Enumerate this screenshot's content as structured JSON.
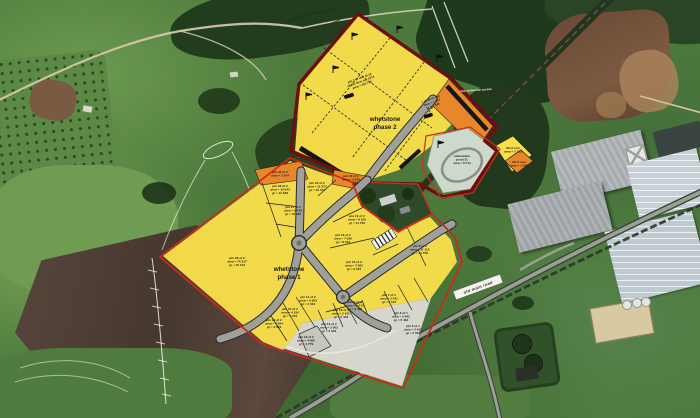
{
  "overlay": {
    "phase2_title_line1": "whetstone",
    "phase2_title_line2": "phase 2",
    "phase1_title_line1": "whetstone",
    "phase1_title_line2": "phase 1",
    "road_label": "old main road",
    "pedestrian_note": "new pedestrian access",
    "pond_note": {
      "l1": "attenuation",
      "l2": "pond 31",
      "l3": "area = 8 714"
    },
    "p2_note1": {
      "l1": "ptn 1 of rem of 12",
      "l2": "of the farm no. 1573",
      "l3": "area = 403 712"
    },
    "p2_note2": {
      "l1": "1 of 29 of rem",
      "l2": "area = 1 727",
      "l3": "gr = 1 694"
    }
  },
  "parcels": [
    {
      "id": "ptn 28 of 2",
      "area": "area = 74 217",
      "gr": "gr = 16 142",
      "x": 237,
      "y": 259
    },
    {
      "id": "ptn 26 of 2",
      "area": "area = 13 043",
      "gr": "gr = 12 569",
      "x": 280,
      "y": 187
    },
    {
      "id": "ptn 25 of 2",
      "area": "area = 11 374",
      "gr": "gr = 10 372",
      "x": 317,
      "y": 184
    },
    {
      "id": "ptn 27 of 2",
      "area": "area = 9 479",
      "gr": "gr = 10 005",
      "x": 293,
      "y": 208
    },
    {
      "id": "ptn 19 of 2",
      "area": "area = 9 155",
      "gr": "gr = 11 479",
      "x": 357,
      "y": 217
    },
    {
      "id": "ptn 18 of 2",
      "area": "area = 7 536",
      "gr": "gr = 8 941",
      "x": 343,
      "y": 236
    },
    {
      "id": "ptn 16 of 2",
      "area": "area = 7 582",
      "gr": "gr = 9 091",
      "x": 354,
      "y": 263
    },
    {
      "id": "ptn 8 of 1",
      "area": "area = 11 115",
      "gr": "gr = 11 758",
      "x": 420,
      "y": 247
    },
    {
      "id": "ptn 11 of 2",
      "area": "area = 5 923",
      "gr": "gr = 4 313",
      "x": 308,
      "y": 298
    },
    {
      "id": "ptn 15 of 2",
      "area": "area = 4 155",
      "gr": "gr = 4 254",
      "x": 290,
      "y": 310
    },
    {
      "id": "ptn 14 of 2",
      "area": "area = 4 594",
      "gr": "gr = 4 523",
      "x": 274,
      "y": 321
    },
    {
      "id": "ptn 13 of 2",
      "area": "area = 4 565",
      "gr": "gr = 4 779",
      "x": 306,
      "y": 338
    },
    {
      "id": "ptn 12 of 2",
      "area": "area = 3 502",
      "gr": "gr = 3 944",
      "x": 329,
      "y": 325
    },
    {
      "id": "ptn 10 of 2",
      "area": "area = 2 411",
      "gr": "gr = 2 432",
      "x": 341,
      "y": 311
    },
    {
      "id": "ptn 9 of 2",
      "area": "area = 3 413",
      "gr": "gr = 3 437",
      "x": 355,
      "y": 303
    },
    {
      "id": "ptn 7 of 1",
      "area": "area = 2 341",
      "gr": "gr = 2 547",
      "x": 389,
      "y": 296
    },
    {
      "id": "ptn 6 of 1",
      "area": "area = 5 041",
      "gr": "gr = 5 432",
      "x": 401,
      "y": 314
    },
    {
      "id": "ptn 5 of 1",
      "area": "area = 2 431",
      "gr": "gr = 2 654",
      "x": 413,
      "y": 327
    },
    {
      "id": "ptn 24 of 2",
      "area": "area = 2 164",
      "gr": null,
      "x": 280,
      "y": 173
    },
    {
      "id": "ptn 22 of 2",
      "area": "area = 2 058",
      "gr": null,
      "x": 351,
      "y": 177
    },
    {
      "id": "30 of rem",
      "area": "area = 2 123",
      "gr": null,
      "x": 513,
      "y": 149
    },
    {
      "id": "29 of rem",
      "area": "area = 1 978",
      "gr": null,
      "x": 519,
      "y": 163
    }
  ],
  "colors": {
    "plot_yellow": "#f8de4a",
    "plot_orange": "#e8872a",
    "phase1_boundary_red": "#d02818",
    "phase2_border_maroon": "#6e0e0e",
    "road_gray": "#a0a09a",
    "pond_gray_green": "#cdd9cb",
    "quarry_light": "#d7d6cd"
  }
}
